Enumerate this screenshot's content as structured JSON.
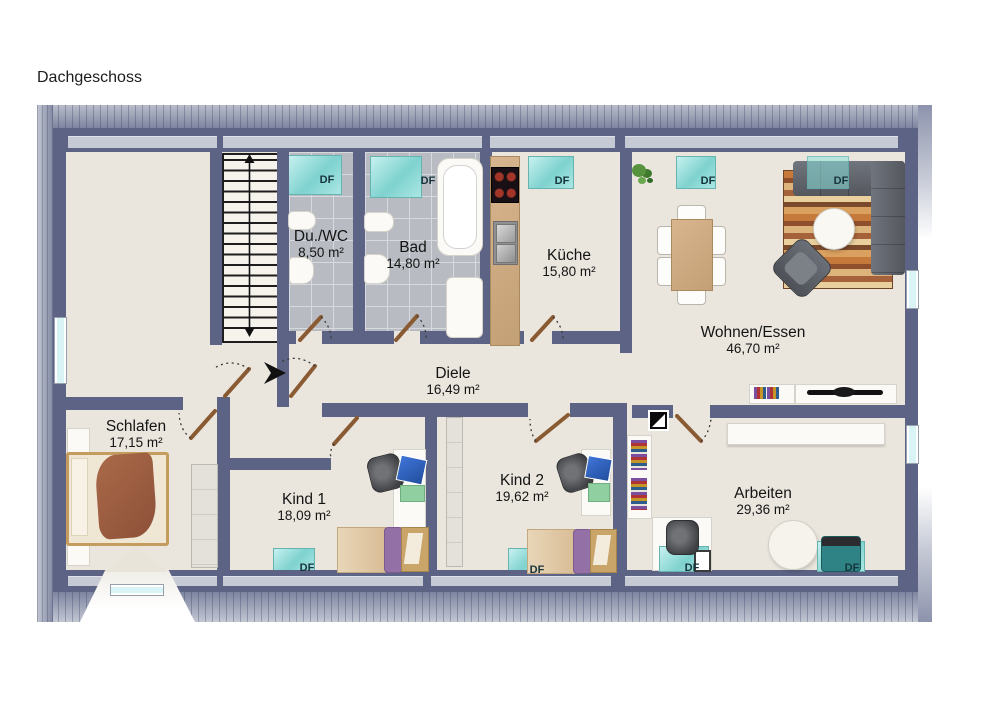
{
  "title": "Dachgeschoss",
  "labels": {
    "df": "DF"
  },
  "rooms": [
    {
      "id": "du_wc",
      "name": "Du./WC",
      "area": "8,50 m²"
    },
    {
      "id": "bad",
      "name": "Bad",
      "area": "14,80 m²"
    },
    {
      "id": "kueche",
      "name": "Küche",
      "area": "15,80 m²"
    },
    {
      "id": "wohnen_essen",
      "name": "Wohnen/Essen",
      "area": "46,70 m²"
    },
    {
      "id": "diele",
      "name": "Diele",
      "area": "16,49 m²"
    },
    {
      "id": "schlafen",
      "name": "Schlafen",
      "area": "17,15 m²"
    },
    {
      "id": "kind1",
      "name": "Kind 1",
      "area": "18,09 m²"
    },
    {
      "id": "kind2",
      "name": "Kind 2",
      "area": "19,62 m²"
    },
    {
      "id": "arbeiten",
      "name": "Arbeiten",
      "area": "29,36 m²"
    }
  ],
  "colors": {
    "wall": "#5d6384",
    "floor": "#eae6de",
    "tile": "#b8bcc2",
    "skylight": "#7ed2cf",
    "roof": "#8d93ac",
    "wood_door": "#8a5a33"
  }
}
